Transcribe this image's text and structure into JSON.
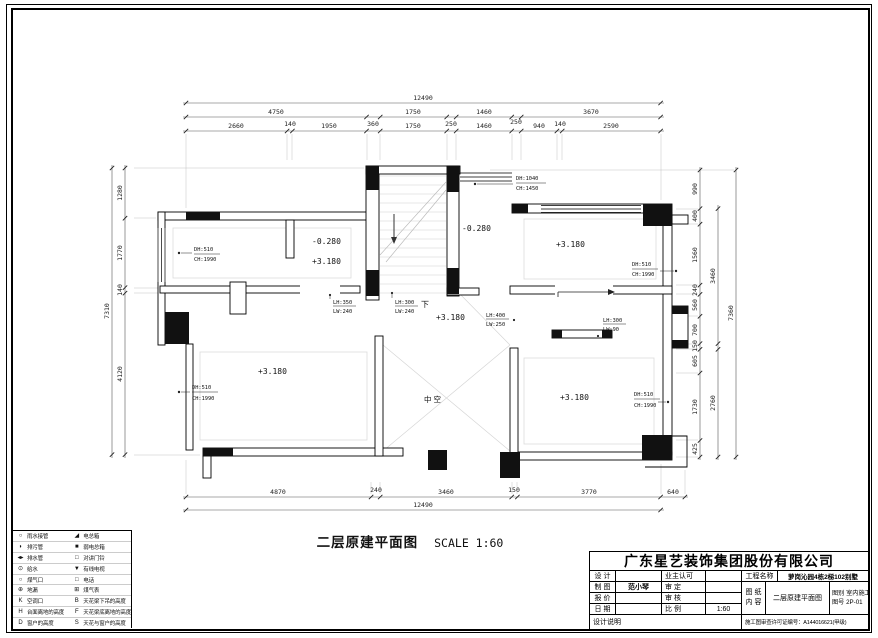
{
  "page": {
    "title_main": "二层原建平面图",
    "title_scale": "SCALE 1:60"
  },
  "dims": {
    "top_overall": "12490",
    "top_mid": [
      "4750",
      "1750",
      "1460",
      "3670"
    ],
    "top_detail": [
      "2660",
      "140",
      "1950",
      "360",
      "1750",
      "250",
      "1460",
      "250",
      "940",
      "140",
      "2590"
    ],
    "bottom_detail": [
      "4870",
      "240",
      "3460",
      "150",
      "3770",
      "640"
    ],
    "bottom_overall": "12490",
    "left_detail": [
      "1280",
      "1770",
      "140",
      "4120"
    ],
    "left_overall": "7310",
    "right_detail": [
      "990",
      "400",
      "1560",
      "240",
      "560",
      "700",
      "150",
      "605",
      "1730",
      "425"
    ],
    "right_mid": [
      "3460",
      "2760"
    ],
    "right_overall": "7360"
  },
  "labels": {
    "tl_dh": "DH:510",
    "tl_ch": "CH:1990",
    "hall_neg": "-0.280",
    "hall_pos": "+3.180",
    "entry_neg": "-0.280",
    "door_dh": "DH:1040",
    "door_ch": "CH:1450",
    "tr_level": "+3.180",
    "tr_dh": "DH:510",
    "tr_ch": "CH:1990",
    "beam1_lh": "LH:350",
    "beam1_lw": "LW:240",
    "beam2_lh": "LH:300",
    "beam2_lw": "LW:240",
    "beam3_lh": "LH:400",
    "beam3_lw": "LW:250",
    "beam4_lh": "LH:300",
    "beam4_lw": "LW:90",
    "stair_down": "下",
    "stair_level": "+3.180",
    "bl_level": "+3.180",
    "bl_dh": "DH:510",
    "bl_ch": "CH:1990",
    "void": "中空",
    "br_level": "+3.180",
    "br_dh": "DH:510",
    "br_ch": "CH:1990"
  },
  "legend": {
    "left": [
      {
        "glyph": "○",
        "label": "雨水接管"
      },
      {
        "glyph": "◗",
        "label": "排污管"
      },
      {
        "glyph": "◂▸",
        "label": "排水管"
      },
      {
        "glyph": "⊙",
        "label": "给水"
      },
      {
        "glyph": "○",
        "label": "煤气口"
      },
      {
        "glyph": "⊕",
        "label": "地漏"
      },
      {
        "glyph": "K",
        "label": "空调口"
      },
      {
        "glyph": "H",
        "label": "台面离地的高度"
      },
      {
        "glyph": "D",
        "label": "窗户的高度"
      }
    ],
    "right": [
      {
        "glyph": "◢",
        "label": "电总箱"
      },
      {
        "glyph": "■",
        "label": "弱电总箱"
      },
      {
        "glyph": "□",
        "label": "对讲门铃"
      },
      {
        "glyph": "▼",
        "label": "有线电视"
      },
      {
        "glyph": "□",
        "label": "电话"
      },
      {
        "glyph": "⊞",
        "label": "煤气表"
      },
      {
        "glyph": "B",
        "label": "天花梁下吊的高度"
      },
      {
        "glyph": "F",
        "label": "天花梁底离地的高度"
      },
      {
        "glyph": "S",
        "label": "天花与窗户的高度"
      }
    ]
  },
  "titleblock": {
    "company": "广东星艺装饰集团股份有限公司",
    "design_label": "设 计",
    "owner_label": "业主认可",
    "project_label": "工程名称",
    "project": "萝岗沁园4栋2梯102别墅",
    "draft_label": "制 图",
    "draft_name": "范小琴",
    "approve_label": "审 定",
    "quote_label": "报 价",
    "review_label": "审 核",
    "date_label": "日 期",
    "scale_label": "比 例",
    "scale": "1:60",
    "sheet_label_1": "图 纸",
    "sheet_label_2": "内 容",
    "sheet_name": "二层原建平面图",
    "category_label": "图别",
    "category": "室内施工图",
    "number_label": "图号",
    "number": "2P-01",
    "note_label": "设计说明",
    "permit": "施工图审查许可证编号：A144016621(甲级)"
  }
}
